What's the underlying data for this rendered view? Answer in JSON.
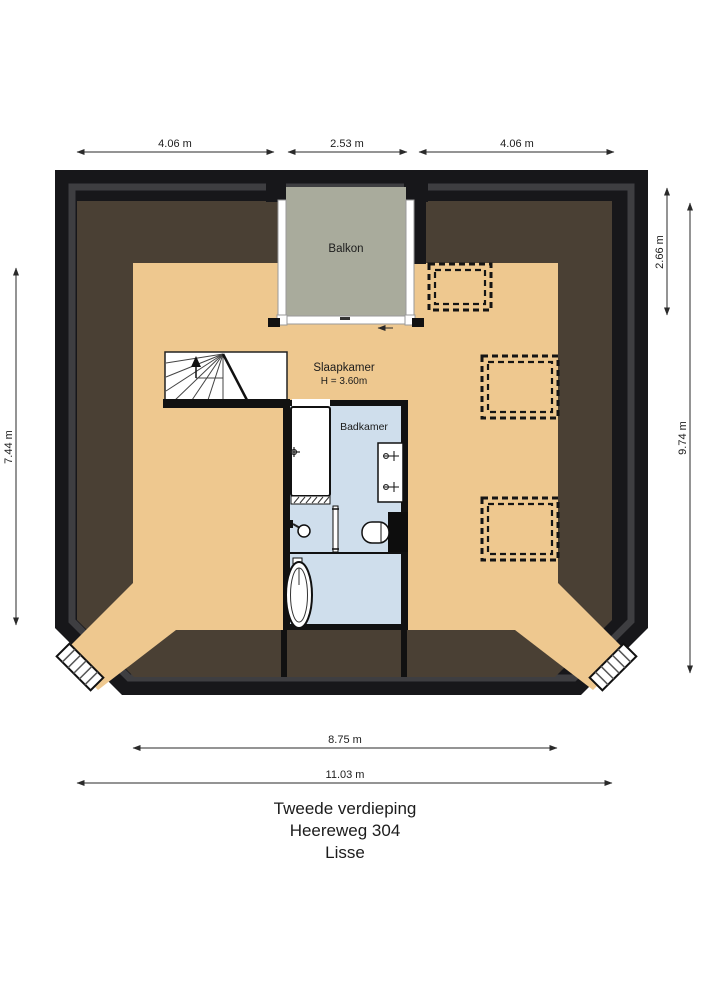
{
  "plan": {
    "rooms": {
      "balcony": {
        "label": "Balkon"
      },
      "bedroom": {
        "label": "Slaapkamer",
        "height_note": "H = 3.60m"
      },
      "bathroom": {
        "label": "Badkamer"
      }
    },
    "dimensions": {
      "top_left": "4.06 m",
      "top_center": "2.53 m",
      "top_right": "4.06 m",
      "right_balcony_depth": "2.66 m",
      "right_total": "9.74 m",
      "left_total": "7.44 m",
      "bottom_interior": "8.75 m",
      "bottom_total": "11.03 m"
    },
    "footer": {
      "floor": "Tweede verdieping",
      "street": "Heereweg 304",
      "city": "Lisse"
    },
    "colors": {
      "wall": "#17171a",
      "wall_inner": "#3e3e41",
      "roof": "#4a4034",
      "floor": "#eec88f",
      "balcony_floor": "#a9ab9c",
      "bathroom_floor": "#cfdeec",
      "fixture": "#ffffff"
    }
  }
}
